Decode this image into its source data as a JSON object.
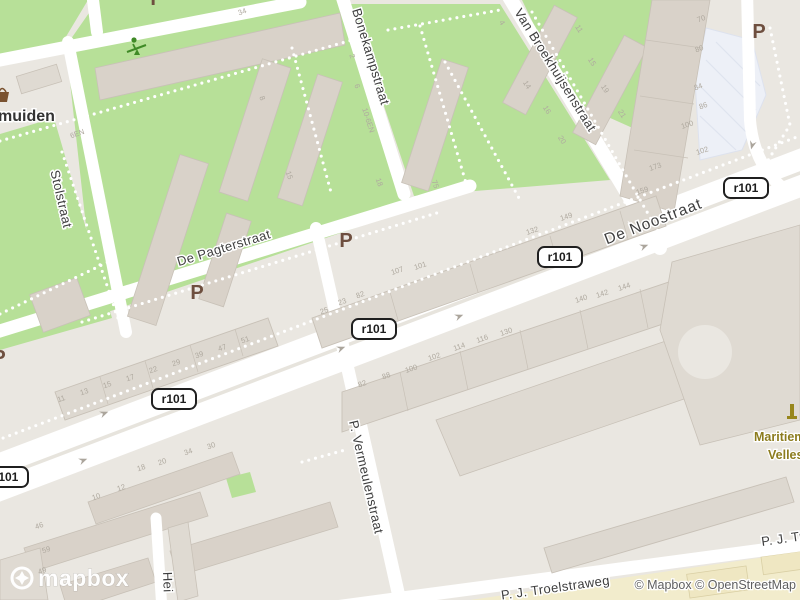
{
  "map": {
    "attribution": "© Mapbox © OpenStreetMap",
    "logo_text": "mapbox",
    "colors": {
      "land": "#EAE7E1",
      "green": "#B7E098",
      "road": "#FFFFFF",
      "median": "#E7E4DD",
      "building": "#D9D2C9",
      "building_light": "#DFDAD2",
      "building_stroke": "#C8C1B7",
      "slab": "#DDD8D0",
      "parking_fill": "#EDF0F7",
      "school_yellow": "#F2ECCC",
      "label": "#3E3E3E",
      "housenum": "#AFA99F",
      "shield_border": "#1F1F1F",
      "p_color": "#6E4F3F",
      "poi_olive": "#8C7C1E",
      "attribution": "#5F5F5F",
      "dots": "#FFFFFF",
      "arrow": "#ABA59C",
      "icon_green": "#3F8A26",
      "icon_brown": "#7A5230"
    },
    "street_labels": [
      {
        "text": "Bonekampstraat",
        "x": 352,
        "y": 10,
        "rot": 73,
        "size": 13,
        "anchor": "start"
      },
      {
        "text": "Van Broekhuijsenstraat",
        "x": 514,
        "y": 12,
        "rot": 58,
        "size": 13,
        "anchor": "start"
      },
      {
        "text": "De Pagterstraat",
        "x": 225,
        "y": 252,
        "rot": -17,
        "size": 13.5,
        "anchor": "middle"
      },
      {
        "text": "De Noostraat",
        "x": 655,
        "y": 226,
        "rot": -21,
        "size": 15.5,
        "anchor": "middle",
        "major": true
      },
      {
        "text": "Stolstraat",
        "x": 57,
        "y": 200,
        "rot": 77,
        "size": 13,
        "anchor": "middle"
      },
      {
        "text": "P. Vermeulenstraat",
        "x": 362,
        "y": 478,
        "rot": 77,
        "size": 13,
        "anchor": "middle"
      },
      {
        "text": "P. J. Troelstraweg",
        "x": 556,
        "y": 592,
        "rot": -8,
        "size": 13,
        "anchor": "middle"
      },
      {
        "text": "P. J. Troelstraweg",
        "x": 762,
        "y": 546,
        "rot": -8,
        "size": 13,
        "anchor": "start"
      },
      {
        "text": "Hei",
        "x": 163,
        "y": 572,
        "rot": 88,
        "size": 12.5,
        "anchor": "start"
      }
    ],
    "place_labels": [
      {
        "text": "muiden",
        "x": -2,
        "y": 121
      }
    ],
    "poi_labels": [
      {
        "text": "Maritiem",
        "x": 754,
        "y": 441
      },
      {
        "text": "Velles",
        "x": 768,
        "y": 459
      }
    ],
    "route_shields": [
      {
        "text": "r101",
        "x": 6,
        "y": 477
      },
      {
        "text": "r101",
        "x": 174,
        "y": 399
      },
      {
        "text": "r101",
        "x": 374,
        "y": 329
      },
      {
        "text": "r101",
        "x": 560,
        "y": 257
      },
      {
        "text": "r101",
        "x": 746,
        "y": 188
      }
    ],
    "parking_symbols": [
      {
        "text": "P",
        "x": 157,
        "y": 5
      },
      {
        "text": "P",
        "x": 759,
        "y": 38
      },
      {
        "text": "P",
        "x": 346,
        "y": 247
      },
      {
        "text": "P",
        "x": 197,
        "y": 299
      },
      {
        "text": "P",
        "x": -1,
        "y": 364
      }
    ],
    "one_way_arrows": [
      {
        "x": 84,
        "y": 460,
        "rot": -21
      },
      {
        "x": 105,
        "y": 413,
        "rot": -21
      },
      {
        "x": 342,
        "y": 348,
        "rot": -21
      },
      {
        "x": 460,
        "y": 316,
        "rot": -21
      },
      {
        "x": 645,
        "y": 246,
        "rot": -21
      },
      {
        "x": 752,
        "y": 146,
        "rot": 105
      }
    ],
    "house_numbers": [
      {
        "text": "11",
        "x": 62,
        "y": 401,
        "rot": -19
      },
      {
        "text": "13",
        "x": 85,
        "y": 394,
        "rot": -19
      },
      {
        "text": "15",
        "x": 108,
        "y": 387,
        "rot": -19
      },
      {
        "text": "17",
        "x": 131,
        "y": 380,
        "rot": -19
      },
      {
        "text": "22",
        "x": 154,
        "y": 372,
        "rot": -19
      },
      {
        "text": "29",
        "x": 177,
        "y": 365,
        "rot": -19
      },
      {
        "text": "39",
        "x": 200,
        "y": 357,
        "rot": -19
      },
      {
        "text": "47",
        "x": 223,
        "y": 350,
        "rot": -19
      },
      {
        "text": "51",
        "x": 246,
        "y": 342,
        "rot": -19
      },
      {
        "text": "25",
        "x": 325,
        "y": 313,
        "rot": -19
      },
      {
        "text": "23",
        "x": 343,
        "y": 304,
        "rot": -19
      },
      {
        "text": "82",
        "x": 361,
        "y": 297,
        "rot": -19
      },
      {
        "text": "107",
        "x": 398,
        "y": 273,
        "rot": -19
      },
      {
        "text": "101",
        "x": 421,
        "y": 268,
        "rot": -19
      },
      {
        "text": "132",
        "x": 533,
        "y": 233,
        "rot": -19
      },
      {
        "text": "149",
        "x": 567,
        "y": 219,
        "rot": -19
      },
      {
        "text": "159",
        "x": 643,
        "y": 193,
        "rot": -19
      },
      {
        "text": "70",
        "x": 702,
        "y": 21,
        "rot": -19
      },
      {
        "text": "80",
        "x": 700,
        "y": 51,
        "rot": -19
      },
      {
        "text": "84",
        "x": 699,
        "y": 89,
        "rot": -19
      },
      {
        "text": "86",
        "x": 704,
        "y": 108,
        "rot": -19
      },
      {
        "text": "100",
        "x": 688,
        "y": 127,
        "rot": -19
      },
      {
        "text": "102",
        "x": 703,
        "y": 153,
        "rot": -19
      },
      {
        "text": "173",
        "x": 656,
        "y": 169,
        "rot": -19
      },
      {
        "text": "82",
        "x": 363,
        "y": 386,
        "rot": -19
      },
      {
        "text": "88",
        "x": 387,
        "y": 378,
        "rot": -19
      },
      {
        "text": "100",
        "x": 412,
        "y": 371,
        "rot": -19
      },
      {
        "text": "102",
        "x": 435,
        "y": 359,
        "rot": -19
      },
      {
        "text": "114",
        "x": 460,
        "y": 349,
        "rot": -19
      },
      {
        "text": "116",
        "x": 483,
        "y": 341,
        "rot": -19
      },
      {
        "text": "130",
        "x": 507,
        "y": 334,
        "rot": -19
      },
      {
        "text": "140",
        "x": 582,
        "y": 301,
        "rot": -19
      },
      {
        "text": "142",
        "x": 603,
        "y": 296,
        "rot": -19
      },
      {
        "text": "144",
        "x": 625,
        "y": 289,
        "rot": -19
      },
      {
        "text": "46",
        "x": 40,
        "y": 528,
        "rot": -19
      },
      {
        "text": "59",
        "x": 47,
        "y": 552,
        "rot": -19
      },
      {
        "text": "49",
        "x": 43,
        "y": 573,
        "rot": -19
      },
      {
        "text": "10",
        "x": 97,
        "y": 499,
        "rot": -19
      },
      {
        "text": "12",
        "x": 122,
        "y": 490,
        "rot": -19
      },
      {
        "text": "18",
        "x": 142,
        "y": 470,
        "rot": -19
      },
      {
        "text": "20",
        "x": 163,
        "y": 464,
        "rot": -19
      },
      {
        "text": "34",
        "x": 189,
        "y": 454,
        "rot": -19
      },
      {
        "text": "30",
        "x": 212,
        "y": 448,
        "rot": -19
      },
      {
        "text": "34",
        "x": 243,
        "y": 14,
        "rot": -19
      },
      {
        "text": "8",
        "x": 260,
        "y": 99,
        "rot": 70
      },
      {
        "text": "15",
        "x": 287,
        "y": 176,
        "rot": 70
      },
      {
        "text": "2",
        "x": 350,
        "y": 57,
        "rot": 70
      },
      {
        "text": "6",
        "x": 355,
        "y": 87,
        "rot": 70
      },
      {
        "text": "10-6EN",
        "x": 366,
        "y": 121,
        "rot": 72
      },
      {
        "text": "18",
        "x": 377,
        "y": 183,
        "rot": 70
      },
      {
        "text": "6EN",
        "x": 78,
        "y": 136,
        "rot": -19
      },
      {
        "text": "4",
        "x": 500,
        "y": 24,
        "rot": 58
      },
      {
        "text": "14",
        "x": 525,
        "y": 86,
        "rot": 58
      },
      {
        "text": "16",
        "x": 545,
        "y": 111,
        "rot": 58
      },
      {
        "text": "20",
        "x": 560,
        "y": 141,
        "rot": 58
      },
      {
        "text": "11",
        "x": 577,
        "y": 30,
        "rot": 58
      },
      {
        "text": "15",
        "x": 590,
        "y": 63,
        "rot": 58
      },
      {
        "text": "19",
        "x": 603,
        "y": 90,
        "rot": 58
      },
      {
        "text": "21",
        "x": 620,
        "y": 115,
        "rot": 58
      },
      {
        "text": "75",
        "x": 433,
        "y": 185,
        "rot": 70
      }
    ]
  }
}
